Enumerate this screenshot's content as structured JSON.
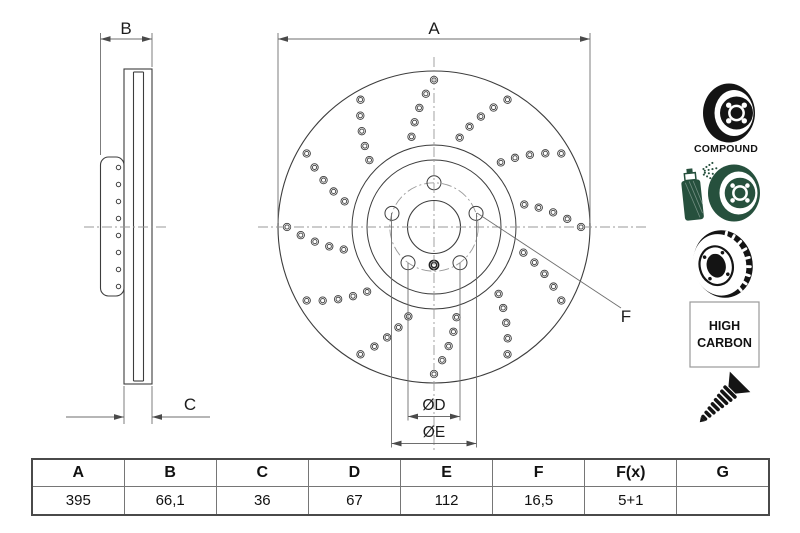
{
  "drawing": {
    "labels": {
      "a": "A",
      "b": "B",
      "c": "C",
      "diam_d": "ØD",
      "diam_e": "ØE",
      "f": "F"
    },
    "front": {
      "cx": 434,
      "cy": 227,
      "r_outer": 156,
      "r_friction": 82,
      "r_hat": 67,
      "r_bolt": 44.2,
      "r_bore": 26.5,
      "bolt_hole_r": 7,
      "bolt_angles": [
        90,
        162,
        18,
        234,
        306
      ],
      "pin_dy": 38,
      "pin_r1": 4.6,
      "pin_r2": 2.6,
      "drill": {
        "arms": 12,
        "per_arm": 5,
        "r0": 93,
        "dr": 13.5,
        "a0": 104,
        "da_arm": 30,
        "da_hole": -3.5,
        "hole_r1": 3.7,
        "hole_r2": 2.1
      },
      "centerline_h": {
        "y": 227,
        "x1": 258,
        "x2": 648
      },
      "centerline_v": {
        "x": 434,
        "y1": 57,
        "y2": 450
      }
    },
    "side": {
      "hat": {
        "x": 100.5,
        "y": 157,
        "w": 23.5,
        "h": 139,
        "rx": 8
      },
      "hat_holes": {
        "cx": 118.5,
        "r": 2.2,
        "ys": [
          167.5,
          184.5,
          201.5,
          218.5,
          235.5,
          252.5,
          269.5,
          286.5
        ]
      },
      "rotor": {
        "x": 124,
        "y": 69,
        "w": 28,
        "h": 315
      },
      "vent": {
        "x1": 133.5,
        "x2": 143.5,
        "y1": 72,
        "y2": 381
      },
      "centerline": {
        "y": 227,
        "x1": 84,
        "x2": 168
      }
    },
    "dims": {
      "A": {
        "y": 39,
        "x1": 278,
        "x2": 590,
        "label_x": 434,
        "label_y": 34,
        "ext": [
          [
            278,
            33,
            223
          ],
          [
            590,
            33,
            223
          ]
        ]
      },
      "B": {
        "y": 39,
        "x1": 100.5,
        "x2": 152,
        "label_x": 126,
        "label_y": 34,
        "ext": [
          [
            100.5,
            33,
            155
          ],
          [
            152,
            33,
            67
          ]
        ]
      },
      "C": {
        "y": 417,
        "x1": 124,
        "x2": 152,
        "tail": 58,
        "label_x": 190,
        "label_y": 410,
        "ext": [
          [
            124,
            386,
            424
          ],
          [
            152,
            386,
            424
          ]
        ]
      },
      "D": {
        "y": 416.5,
        "x1": 408,
        "x2": 460,
        "label_x": 434,
        "label_y": 410,
        "ext": [
          [
            408,
            263,
            420.5
          ],
          [
            460,
            263,
            420.5
          ]
        ]
      },
      "E": {
        "y": 443.5,
        "x1": 391.5,
        "x2": 476.5,
        "label_x": 434,
        "label_y": 437,
        "ext": [
          [
            391.5,
            213,
            447.5
          ],
          [
            476.5,
            213,
            447.5
          ]
        ]
      },
      "F": {
        "x1": 477,
        "y1": 213,
        "x2": 621,
        "y2": 308,
        "label_x": 626,
        "label_y": 322
      }
    }
  },
  "icons": {
    "compound_label": "COMPOUND",
    "high_carbon_line1": "HIGH",
    "high_carbon_line2": "CARBON"
  },
  "table": {
    "headers": [
      "A",
      "B",
      "C",
      "D",
      "E",
      "F",
      "F(x)",
      "G"
    ],
    "values": [
      "395",
      "66,1",
      "36",
      "67",
      "112",
      "16,5",
      "5+1",
      ""
    ]
  },
  "colors": {
    "outline": "#3d3d3d",
    "dim": "#6e6e6e",
    "arrow": "#4a4a4a",
    "centerline": "#999999",
    "text": "#1c1c1c",
    "icon_black": "#141414",
    "icon_green": "#26503d",
    "table_border": "#4a4a4a"
  }
}
